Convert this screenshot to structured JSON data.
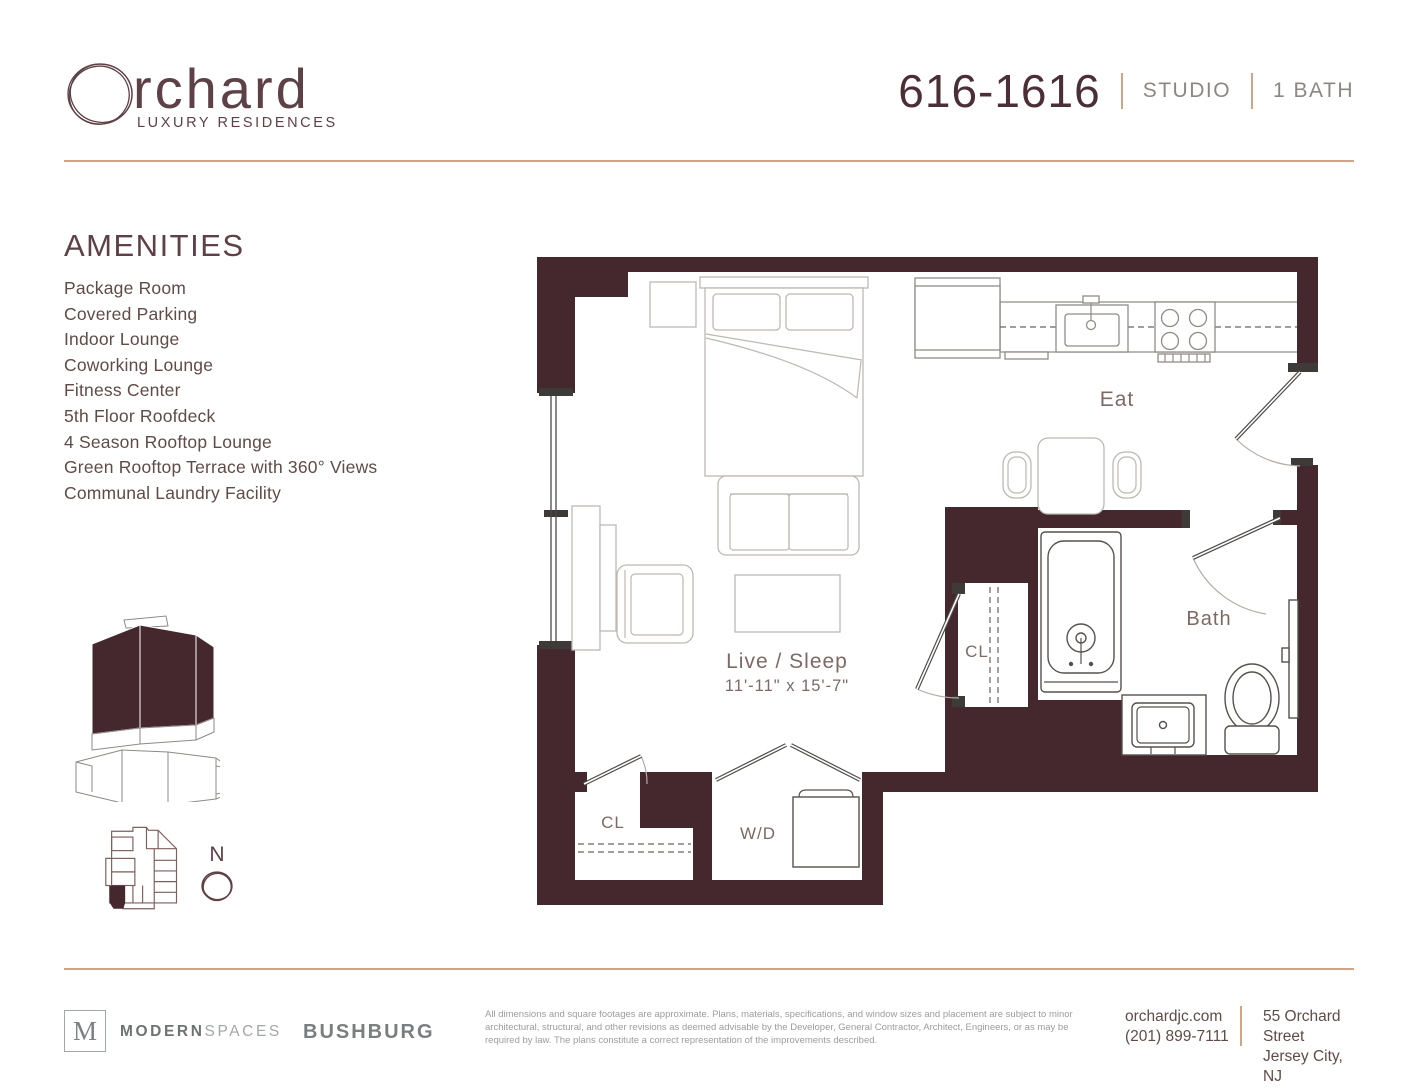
{
  "brand": {
    "name_rest": "rchard",
    "tagline": "LUXURY RESIDENCES"
  },
  "unit_header": {
    "unit_number": "616-1616",
    "layout": "STUDIO",
    "bath": "1 BATH"
  },
  "amenities": {
    "title": "AMENITIES",
    "items": [
      "Package Room",
      "Covered Parking",
      "Indoor Lounge",
      "Coworking Lounge",
      "Fitness Center",
      "5th Floor Roofdeck",
      "4 Season Rooftop Lounge",
      "Green Rooftop Terrace with 360° Views",
      "Communal Laundry Facility"
    ]
  },
  "floor_plan": {
    "room_labels": {
      "eat": "Eat",
      "live_sleep": "Live / Sleep",
      "live_sleep_dimensions": "11'-11\" x 15'-7\"",
      "bath": "Bath",
      "closet_middle": "CL",
      "closet_lower": "CL",
      "washer_dryer": "W/D"
    },
    "compass": {
      "north": "N"
    }
  },
  "footer": {
    "modern_spaces": {
      "logo_letter": "M",
      "name_bold": "MODERN",
      "name_light": "SPACES"
    },
    "bushburg": "BUSHBURG",
    "disclaimer": "All dimensions and square footages are approximate. Plans, materials, specifications, and window sizes and placement are subject to minor architectural, structural, and other revisions as deemed advisable by the Developer, General Contractor, Architect, Engineers, or as may be required by law. The plans constitute a correct representation of the improvements described.",
    "website": "orchardjc.com",
    "phone": "(201) 899-7111",
    "address": {
      "line1": "55 Orchard Street",
      "line2": "Jersey City, NJ"
    }
  },
  "colors": {
    "wall": "#44282e",
    "brand": "#5e4147",
    "unitnum": "#4c2f36",
    "tan": "#d0a586",
    "graylabel": "#8c8783",
    "body": "#5f4b47",
    "label": "#7d6a66",
    "furniture": "#bcb8b4",
    "fixture": "#56514d",
    "kitchen": "#908c88",
    "disclaimer": "#9c9c9c",
    "footergray": "#7b8080",
    "footerlight": "#a2a7a7",
    "arc": "#b3aba5"
  }
}
